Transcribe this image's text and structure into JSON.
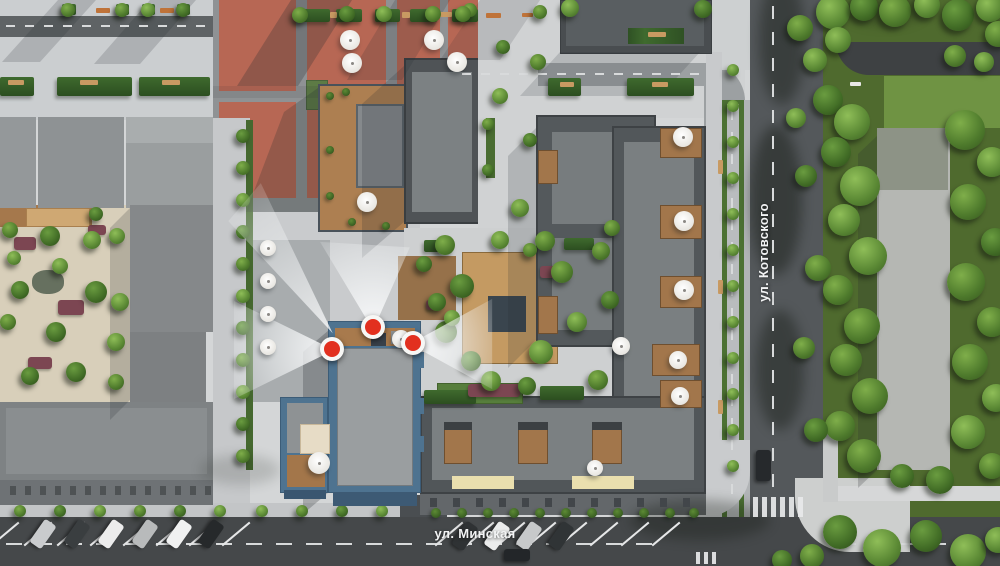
{
  "meta": {
    "type": "aerial-site-plan-render",
    "width_px": 1000,
    "height_px": 566
  },
  "streets": {
    "vertical_label": "ул. Котовского",
    "horizontal_label": "ул. Минская"
  },
  "palette": {
    "red_plaza": "#b76754",
    "roof_dark": "#52575a",
    "roof_light": "#9a9ea0",
    "selected_building_blue": "#4e7390",
    "marker_red": "#e2301f",
    "grass": "#4f6a2e",
    "road": "#54585b",
    "pavement": "#d4d6d7",
    "wood_deck": "#ad7f51",
    "awning_cream": "#eadfae"
  },
  "markers": {
    "description": "red viewpoint markers with white view cones on selected building",
    "items": [
      {
        "id": "marker-top",
        "x": 373,
        "y": 327
      },
      {
        "id": "marker-left",
        "x": 332,
        "y": 349
      },
      {
        "id": "marker-right",
        "x": 413,
        "y": 343
      }
    ]
  },
  "scene": {
    "trees": [
      [
        833,
        12,
        17
      ],
      [
        864,
        7,
        14
      ],
      [
        895,
        11,
        16
      ],
      [
        927,
        5,
        13
      ],
      [
        958,
        15,
        16
      ],
      [
        990,
        8,
        14
      ],
      [
        838,
        40,
        13
      ],
      [
        998,
        34,
        13
      ],
      [
        815,
        60,
        12
      ],
      [
        828,
        100,
        15
      ],
      [
        852,
        122,
        18
      ],
      [
        836,
        152,
        15
      ],
      [
        860,
        186,
        20
      ],
      [
        844,
        220,
        16
      ],
      [
        868,
        256,
        19
      ],
      [
        838,
        290,
        15
      ],
      [
        862,
        326,
        18
      ],
      [
        846,
        360,
        16
      ],
      [
        870,
        396,
        18
      ],
      [
        840,
        426,
        15
      ],
      [
        864,
        456,
        17
      ],
      [
        965,
        130,
        20
      ],
      [
        992,
        162,
        15
      ],
      [
        968,
        202,
        18
      ],
      [
        995,
        242,
        14
      ],
      [
        966,
        282,
        19
      ],
      [
        992,
        322,
        15
      ],
      [
        970,
        362,
        18
      ],
      [
        996,
        398,
        14
      ],
      [
        968,
        432,
        17
      ],
      [
        992,
        466,
        13
      ],
      [
        940,
        480,
        14
      ],
      [
        902,
        476,
        12
      ],
      [
        840,
        532,
        17
      ],
      [
        882,
        548,
        19
      ],
      [
        926,
        536,
        16
      ],
      [
        968,
        552,
        18
      ],
      [
        998,
        540,
        13
      ],
      [
        812,
        556,
        12
      ],
      [
        782,
        560,
        10
      ],
      [
        806,
        176,
        11
      ],
      [
        818,
        268,
        13
      ],
      [
        804,
        348,
        11
      ],
      [
        816,
        430,
        12
      ],
      [
        800,
        28,
        13
      ],
      [
        796,
        118,
        10
      ],
      [
        955,
        56,
        11
      ],
      [
        984,
        62,
        10
      ],
      [
        10,
        230,
        8
      ],
      [
        50,
        236,
        10
      ],
      [
        92,
        240,
        9
      ],
      [
        117,
        236,
        8
      ],
      [
        20,
        290,
        9
      ],
      [
        96,
        292,
        11
      ],
      [
        120,
        302,
        9
      ],
      [
        8,
        322,
        8
      ],
      [
        56,
        332,
        10
      ],
      [
        116,
        342,
        9
      ],
      [
        30,
        376,
        9
      ],
      [
        76,
        372,
        10
      ],
      [
        116,
        382,
        8
      ],
      [
        96,
        214,
        7
      ],
      [
        60,
        266,
        8
      ],
      [
        14,
        258,
        7
      ],
      [
        445,
        245,
        10
      ],
      [
        462,
        286,
        12
      ],
      [
        500,
        240,
        9
      ],
      [
        545,
        241,
        10
      ],
      [
        562,
        272,
        11
      ],
      [
        446,
        332,
        11
      ],
      [
        471,
        361,
        10
      ],
      [
        541,
        352,
        12
      ],
      [
        577,
        322,
        10
      ],
      [
        601,
        251,
        9
      ],
      [
        491,
        381,
        10
      ],
      [
        527,
        386,
        9
      ],
      [
        424,
        264,
        8
      ],
      [
        610,
        300,
        9
      ],
      [
        598,
        380,
        10
      ],
      [
        612,
        228,
        8
      ],
      [
        437,
        302,
        9
      ],
      [
        452,
        318,
        8
      ],
      [
        20,
        511,
        6
      ],
      [
        60,
        511,
        6
      ],
      [
        100,
        511,
        6
      ],
      [
        140,
        511,
        6
      ],
      [
        180,
        511,
        6
      ],
      [
        220,
        511,
        6
      ],
      [
        262,
        511,
        6
      ],
      [
        302,
        511,
        6
      ],
      [
        342,
        511,
        6
      ],
      [
        382,
        511,
        6
      ],
      [
        733,
        70,
        6
      ],
      [
        733,
        106,
        6
      ],
      [
        733,
        142,
        6
      ],
      [
        733,
        178,
        6
      ],
      [
        733,
        214,
        6
      ],
      [
        733,
        250,
        6
      ],
      [
        733,
        286,
        6
      ],
      [
        733,
        322,
        6
      ],
      [
        733,
        358,
        6
      ],
      [
        733,
        394,
        6
      ],
      [
        733,
        430,
        6
      ],
      [
        733,
        466,
        6
      ],
      [
        243,
        136,
        7
      ],
      [
        243,
        168,
        7
      ],
      [
        243,
        200,
        7
      ],
      [
        243,
        232,
        7
      ],
      [
        243,
        264,
        7
      ],
      [
        243,
        296,
        7
      ],
      [
        243,
        328,
        7
      ],
      [
        243,
        360,
        7
      ],
      [
        243,
        392,
        7
      ],
      [
        243,
        424,
        7
      ],
      [
        243,
        456,
        7
      ],
      [
        68,
        10,
        7
      ],
      [
        122,
        10,
        7
      ],
      [
        148,
        10,
        7
      ],
      [
        183,
        10,
        7
      ],
      [
        470,
        10,
        7
      ],
      [
        540,
        12,
        7
      ],
      [
        503,
        47,
        7
      ],
      [
        570,
        8,
        9
      ],
      [
        703,
        9,
        9
      ],
      [
        300,
        15,
        8
      ],
      [
        347,
        14,
        8
      ],
      [
        384,
        14,
        8
      ],
      [
        433,
        14,
        8
      ],
      [
        463,
        14,
        8
      ],
      [
        500,
        96,
        8
      ],
      [
        520,
        208,
        9
      ],
      [
        538,
        62,
        8
      ],
      [
        530,
        140,
        7
      ],
      [
        530,
        250,
        7
      ],
      [
        488,
        124,
        6
      ],
      [
        488,
        170,
        6
      ]
    ],
    "bushes": [
      [
        436,
        513,
        5
      ],
      [
        462,
        513,
        5
      ],
      [
        488,
        513,
        5
      ],
      [
        514,
        513,
        5
      ],
      [
        540,
        513,
        5
      ],
      [
        566,
        513,
        5
      ],
      [
        592,
        513,
        5
      ],
      [
        618,
        513,
        5
      ],
      [
        644,
        513,
        5
      ],
      [
        670,
        513,
        5
      ],
      [
        694,
        513,
        5
      ],
      [
        306,
        416,
        4
      ],
      [
        290,
        420,
        4
      ],
      [
        340,
        334,
        4
      ],
      [
        352,
        332,
        4
      ],
      [
        398,
        330,
        4
      ],
      [
        410,
        336,
        4
      ],
      [
        330,
        96,
        4
      ],
      [
        346,
        92,
        4
      ],
      [
        330,
        150,
        4
      ],
      [
        330,
        196,
        4
      ],
      [
        352,
        222,
        4
      ],
      [
        386,
        226,
        4
      ]
    ],
    "hedges": [
      [
        0,
        77,
        34,
        19
      ],
      [
        57,
        77,
        75,
        19
      ],
      [
        139,
        77,
        71,
        19
      ],
      [
        295,
        9,
        35,
        13
      ],
      [
        336,
        9,
        26,
        13
      ],
      [
        375,
        9,
        25,
        13
      ],
      [
        410,
        9,
        27,
        13
      ],
      [
        452,
        9,
        26,
        13
      ],
      [
        548,
        78,
        33,
        18
      ],
      [
        627,
        78,
        67,
        18
      ],
      [
        62,
        4,
        14,
        11
      ],
      [
        116,
        4,
        13,
        11
      ],
      [
        142,
        4,
        13,
        11
      ],
      [
        177,
        4,
        13,
        11
      ],
      [
        424,
        240,
        20,
        12
      ],
      [
        564,
        238,
        30,
        12
      ],
      [
        424,
        390,
        52,
        14
      ],
      [
        540,
        386,
        44,
        14
      ]
    ],
    "purple_beds": [
      [
        14,
        237,
        22,
        13
      ],
      [
        58,
        300,
        26,
        15
      ],
      [
        28,
        357,
        24,
        12
      ],
      [
        88,
        225,
        18,
        10
      ],
      [
        468,
        384,
        52,
        13
      ],
      [
        540,
        266,
        20,
        12
      ],
      [
        426,
        300,
        14,
        10
      ]
    ],
    "wood_terraces": [
      [
        660,
        128,
        42,
        30
      ],
      [
        660,
        205,
        42,
        34
      ],
      [
        660,
        276,
        42,
        32
      ],
      [
        652,
        344,
        48,
        32
      ],
      [
        660,
        380,
        42,
        28
      ],
      [
        538,
        150,
        20,
        34
      ],
      [
        538,
        296,
        20,
        38
      ],
      [
        444,
        428,
        28,
        36
      ],
      [
        518,
        428,
        30,
        36
      ],
      [
        592,
        428,
        30,
        36
      ]
    ],
    "dark_strips": [
      [
        444,
        422,
        28,
        8
      ],
      [
        518,
        422,
        30,
        8
      ],
      [
        592,
        422,
        30,
        8
      ]
    ],
    "blue_tabs": [
      [
        417,
        352,
        7,
        16
      ],
      [
        417,
        398,
        7,
        16
      ],
      [
        417,
        436,
        7,
        16
      ]
    ],
    "umbrellas": [
      [
        350,
        40,
        10
      ],
      [
        352,
        63,
        10
      ],
      [
        434,
        40,
        10
      ],
      [
        457,
        62,
        10
      ],
      [
        367,
        202,
        10
      ],
      [
        319,
        463,
        11
      ],
      [
        401,
        339,
        9
      ],
      [
        683,
        137,
        10
      ],
      [
        684,
        221,
        10
      ],
      [
        684,
        290,
        10
      ],
      [
        678,
        360,
        9
      ],
      [
        680,
        396,
        9
      ],
      [
        621,
        346,
        9
      ],
      [
        595,
        468,
        8
      ],
      [
        268,
        248,
        8
      ],
      [
        268,
        281,
        8
      ],
      [
        268,
        314,
        8
      ],
      [
        268,
        347,
        8
      ]
    ],
    "benches": [
      [
        96,
        8,
        14,
        5,
        "o"
      ],
      [
        160,
        8,
        14,
        5,
        "o"
      ],
      [
        486,
        13,
        15,
        5,
        "o"
      ],
      [
        522,
        13,
        11,
        4,
        "o"
      ],
      [
        8,
        80,
        16,
        5,
        "t"
      ],
      [
        80,
        80,
        18,
        5,
        "t"
      ],
      [
        162,
        80,
        18,
        5,
        "t"
      ],
      [
        330,
        12,
        7,
        6,
        "t"
      ],
      [
        402,
        12,
        8,
        6,
        "t"
      ],
      [
        440,
        12,
        12,
        5,
        "t"
      ],
      [
        560,
        82,
        14,
        5,
        "t"
      ],
      [
        648,
        32,
        18,
        5,
        "t"
      ],
      [
        652,
        82,
        16,
        5,
        "t"
      ],
      [
        850,
        82,
        11,
        4,
        "w"
      ],
      [
        718,
        160,
        5,
        14,
        "t"
      ],
      [
        718,
        280,
        5,
        14,
        "t"
      ],
      [
        718,
        400,
        5,
        14,
        "t"
      ]
    ],
    "cars_parked": [
      [
        36,
        520,
        "#c9cbcd"
      ],
      [
        70,
        520,
        "#3a3e40"
      ],
      [
        104,
        520,
        "#ececec"
      ],
      [
        138,
        520,
        "#b8babb"
      ],
      [
        172,
        520,
        "#f0f1f1"
      ],
      [
        204,
        520,
        "#26292b"
      ],
      [
        458,
        522,
        "#2f3234"
      ],
      [
        490,
        522,
        "#ebecec"
      ],
      [
        522,
        522,
        "#c7c9ca"
      ],
      [
        554,
        522,
        "#303436"
      ]
    ],
    "cars_road": [
      [
        756,
        450,
        15,
        31,
        "#26292c"
      ],
      [
        504,
        549,
        26,
        12,
        "#232629"
      ]
    ],
    "markings": {
      "dash_rows": [
        [
          6,
          25,
          11,
          19,
          9,
          2
        ],
        [
          462,
          73,
          13,
          19,
          9,
          2
        ],
        [
          6,
          543,
          22,
          30,
          16,
          2
        ],
        [
          840,
          543,
          6,
          30,
          16,
          2
        ]
      ],
      "dash_cols": [
        [
          731,
          110,
          18,
          22,
          2,
          10
        ],
        [
          772,
          6,
          19,
          26,
          2,
          13
        ]
      ],
      "zebras": [
        [
          753,
          497,
          6,
          9,
          5,
          20
        ],
        [
          696,
          552,
          3,
          8,
          4,
          12
        ]
      ],
      "parking": [
        [
          4,
          516,
          8,
          33,
          36,
          50
        ],
        [
          448,
          516,
          8,
          31,
          36,
          50
        ]
      ],
      "windows": [
        [
          338,
          496,
          8,
          10,
          6,
          4,
          "#9fc0d4"
        ],
        [
          10,
          486,
          14,
          15,
          6,
          9,
          "#4e5254"
        ],
        [
          430,
          498,
          12,
          23,
          7,
          9,
          "#42464a"
        ]
      ]
    },
    "shadows": [
      {
        "p": "58,0 96,0 40,62 2,62",
        "o": 0.18
      },
      {
        "p": "150,0 196,0 140,64 94,64",
        "o": 0.18
      },
      {
        "p": "291,0 352,0 298,86 237,86",
        "o": 0.27
      },
      {
        "p": "395,0 450,0 402,80 347,80",
        "o": 0.18
      },
      {
        "p": "318,88 318,212 246,212 284,112",
        "o": 0.24
      },
      {
        "p": "560,52 700,52 660,96 520,96",
        "o": 0.16
      },
      {
        "p": "404,66 404,222 362,258 362,104",
        "o": 0.2
      },
      {
        "p": "536,128 536,340 508,368 508,156",
        "o": 0.18
      },
      {
        "p": "329,330 329,492 303,514 303,352",
        "o": 0.26
      },
      {
        "p": "130,208 130,400 110,420 110,228",
        "o": 0.2
      },
      {
        "p": "877,136 877,470 858,488 858,154",
        "o": 0.22
      },
      {
        "p": "480,0 540,0 500,60 440,60",
        "o": 0.14
      },
      {
        "p": "213,86 318,86 318,98 213,98",
        "o": 0.1
      }
    ],
    "shade_blobs": [
      [
        782,
        40,
        46,
        130,
        0.38
      ],
      [
        776,
        200,
        52,
        150,
        0.42
      ],
      [
        780,
        370,
        48,
        120,
        0.38
      ],
      [
        700,
        520,
        140,
        40,
        0.3
      ],
      [
        884,
        10,
        80,
        30,
        0.25
      ],
      [
        240,
        470,
        80,
        30,
        0.15
      ]
    ]
  }
}
